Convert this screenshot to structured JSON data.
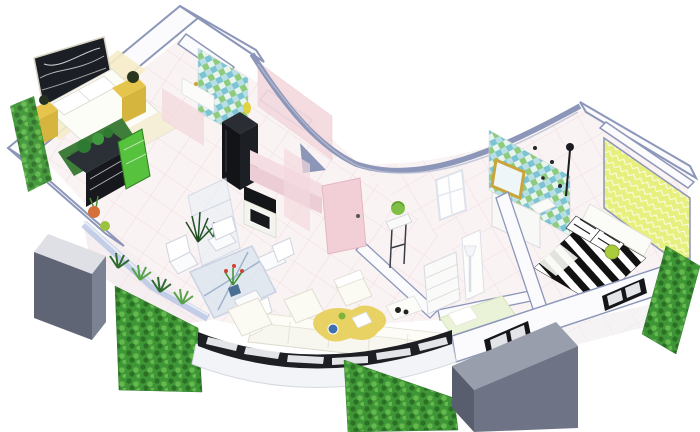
{
  "scene": {
    "title": "3D isometric apartment floor plan render",
    "style": "cutaway dollhouse view, white background, concave curved front wall",
    "background": "#ffffff"
  },
  "palette": {
    "wall-line": "#8c96b8",
    "wall-face": "#fbfbfd",
    "floor": "#faf3f4",
    "grout": "#eed9dd",
    "hedge-base": "#3f9636",
    "hedge-dark": "#2c7026",
    "hedge-light": "#63b94c",
    "planter-top": "#dfe0e6",
    "planter-front": "#5f6575",
    "planter-side": "#7b8293",
    "rail": "#1d1f24",
    "glass": "#aebfe2",
    "mosaic-a": "#7cc3d4",
    "mosaic-b": "#8fcb7d",
    "accent-yellow": "#e6c54d",
    "art": "#1b1e24",
    "rug-green": "#3f7d3a",
    "rug-yellow": "#e8d05c",
    "pink": "#f3d9de",
    "pink-door": "#f2cfd6",
    "cream": "#f6ecc9",
    "zebra": "#121212",
    "wall-chartreuse": "#e7f07e",
    "gold": "#c9a53a",
    "sofa": "#f7f6ef",
    "green-panel": "#57c23e",
    "daybed-green": "#eaf2d8"
  },
  "rooms": [
    {
      "id": "master-bedroom",
      "label": "Master bedroom",
      "furniture": [
        "abstract wall art",
        "double bed",
        "yellow nightstands",
        "green rug",
        "dark dresser with plants",
        "green trellis outside"
      ]
    },
    {
      "id": "kitchen",
      "label": "Kitchen",
      "furniture": [
        "mosaic tile backsplash",
        "black refrigerator",
        "black oven",
        "pink counters"
      ]
    },
    {
      "id": "dining-area",
      "label": "Dining area",
      "furniture": [
        "glass dining table",
        "white chairs",
        "potted centerpiece",
        "glass display cabinet",
        "spiky plant"
      ]
    },
    {
      "id": "living-room",
      "label": "Living room",
      "furniture": [
        "white corner sofa",
        "two white ottomans",
        "white armchair",
        "yellow rug",
        "blue bowl",
        "tv tray table"
      ]
    },
    {
      "id": "hallway",
      "label": "Hallway",
      "furniture": [
        "pink door",
        "plant stand",
        "floor lamp",
        "white lattice window"
      ]
    },
    {
      "id": "bathroom",
      "label": "Bathroom",
      "furniture": [
        "blue mosaic wall",
        "gold framed mirror",
        "white vanity",
        "dark fixtures"
      ]
    },
    {
      "id": "dressing-room",
      "label": "Dressing room",
      "furniture": [
        "open shelf unit",
        "white wardrobe panel",
        "pale green daybed"
      ]
    },
    {
      "id": "bedroom-2",
      "label": "Bedroom 2",
      "furniture": [
        "zebra print bed",
        "white headboard",
        "striped pillows",
        "green pillow",
        "chartreuse accent wall",
        "black floor lamp"
      ]
    },
    {
      "id": "balcony-left",
      "label": "Left balcony",
      "furniture": [
        "gray planter box",
        "blue glass balustrade",
        "agave plants",
        "hedge"
      ]
    },
    {
      "id": "balcony-front",
      "label": "Front balcony",
      "furniture": [
        "black railing with glass slots",
        "hedge"
      ]
    },
    {
      "id": "balcony-right",
      "label": "Right balcony",
      "furniture": [
        "gray planter box",
        "hedge",
        "black framed windows"
      ]
    }
  ],
  "counts": {
    "bedrooms": 2,
    "hedges": 3,
    "planter-boxes": 2,
    "doors": 1,
    "windows": 3
  }
}
